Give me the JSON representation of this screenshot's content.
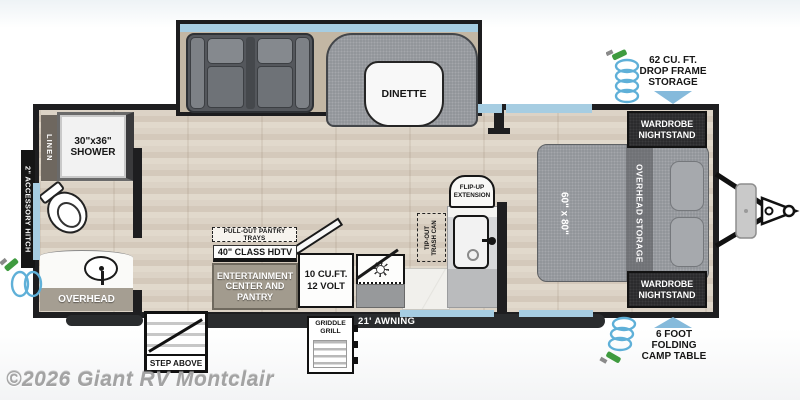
{
  "watermark": "©2026 Giant RV Montclair",
  "exterior": {
    "accessory_hitch": "2\" ACCESSORY HITCH",
    "awning": "21' AWNING",
    "step": "STEP ABOVE",
    "griddle": [
      "GRIDDLE",
      "GRILL"
    ],
    "drop_frame_storage": [
      "62 CU. FT.",
      "DROP FRAME",
      "STORAGE"
    ],
    "camp_table": [
      "6 FOOT",
      "FOLDING",
      "CAMP TABLE"
    ]
  },
  "bathroom": {
    "linen": "LINEN",
    "shower": [
      "30\"x36\"",
      "SHOWER"
    ],
    "overhead": "OVERHEAD"
  },
  "living": {
    "dinette": "DINETTE",
    "pantry_trays": "PULL-OUT PANTRY TRAYS",
    "hdtv": "40\" CLASS HDTV",
    "entertainment": [
      "ENTERTAINMENT",
      "CENTER AND",
      "PANTRY"
    ]
  },
  "kitchen": {
    "refrigerator": [
      "10 CU.FT.",
      "12 VOLT"
    ],
    "flip_up": [
      "FLIP-UP",
      "EXTENSION"
    ],
    "trash": [
      "TIP-OUT",
      "TRASH CAN"
    ]
  },
  "bedroom": {
    "bed_size": "60\" x 80\"",
    "overhead_storage": "OVERHEAD STORAGE",
    "wardrobe_front": [
      "WARDROBE",
      "NIGHTSTAND"
    ],
    "wardrobe_rear": [
      "WARDROBE",
      "NIGHTSTAND"
    ]
  },
  "colors": {
    "wall": "#1e1e20",
    "window_blue": "#a6cde2",
    "arrow_blue": "#85badb",
    "coil_blue": "#5fb0d8",
    "nozzle_green": "#3f9b3f",
    "floor_tan": "#d8cec1",
    "fabric_gray": "#8e9196",
    "cabinet_dark": "#2b2b2d",
    "counter_gray": "#c6c7c9",
    "entertainment_gray": "#a29b8e"
  }
}
